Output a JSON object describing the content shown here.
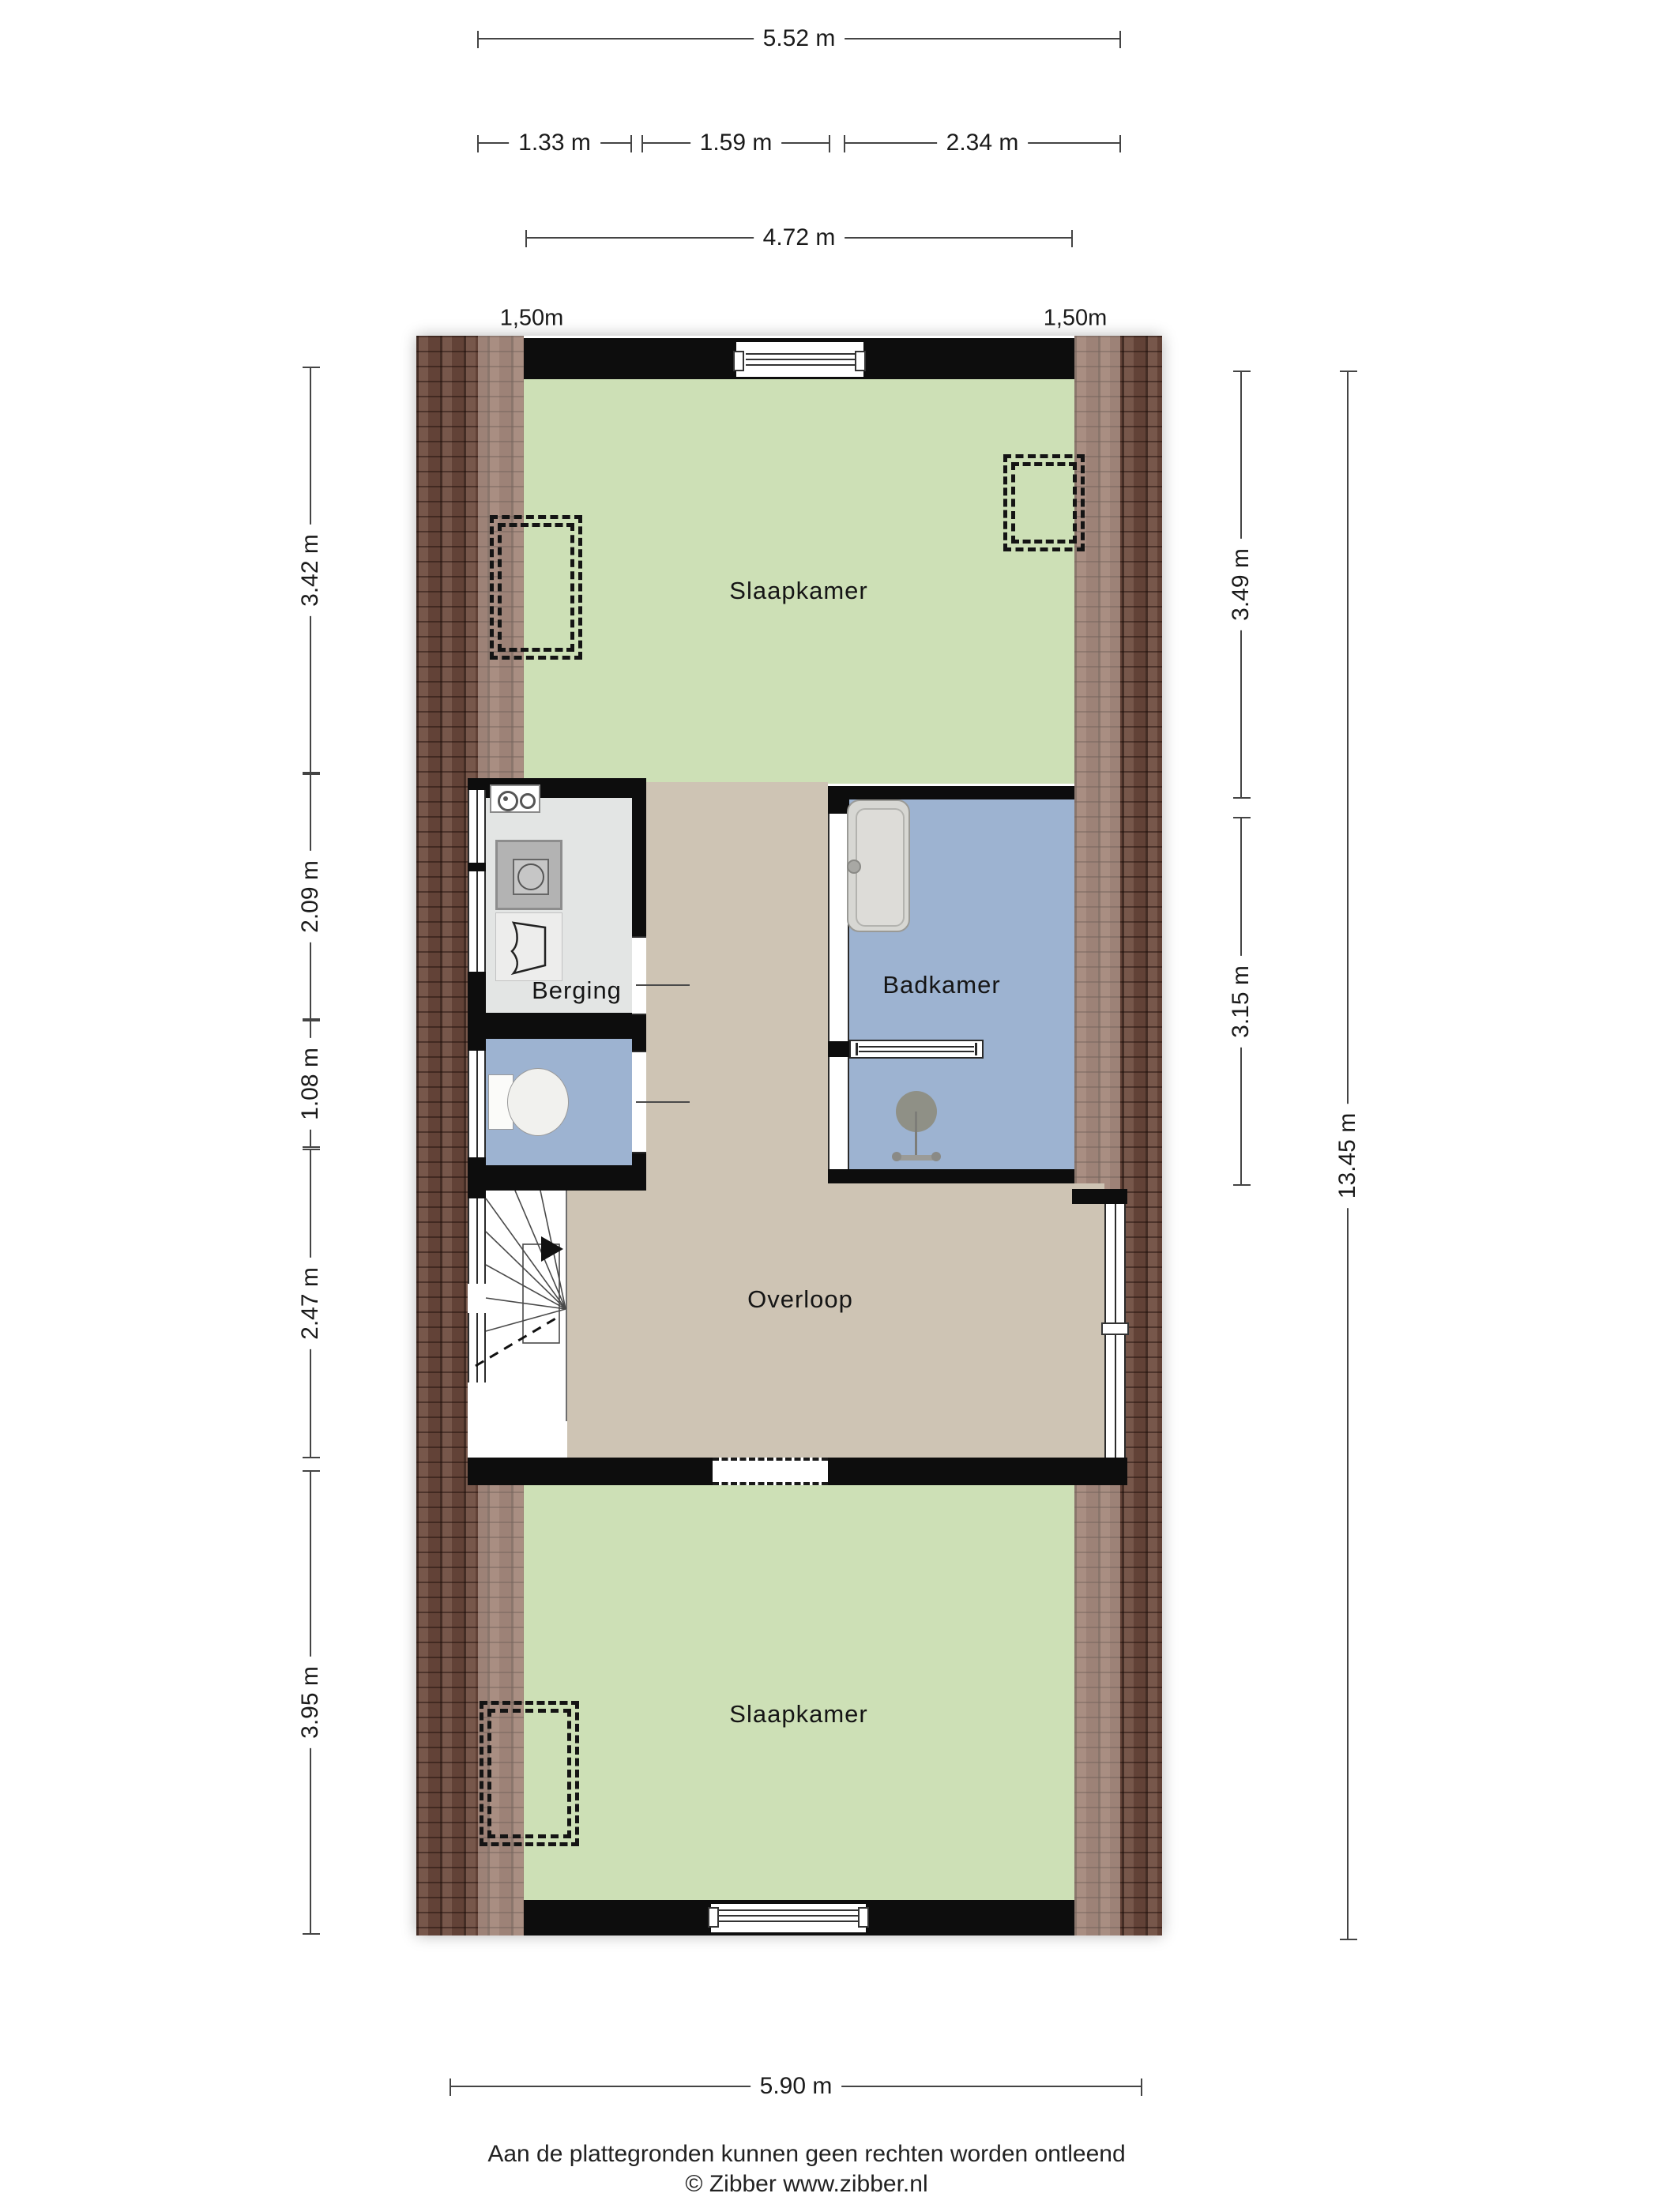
{
  "rooms": {
    "bedroom_top": {
      "label": "Slaapkamer"
    },
    "storage": {
      "label": "Berging"
    },
    "bathroom": {
      "label": "Badkamer"
    },
    "landing": {
      "label": "Overloop"
    },
    "bedroom_bottom": {
      "label": "Slaapkamer"
    }
  },
  "dimensions": {
    "top_total": "5.52 m",
    "top_seg1": "1.33 m",
    "top_seg2": "1.59 m",
    "top_seg3": "2.34 m",
    "top_inner": "4.72 m",
    "headroom_left": "1,50m",
    "headroom_right": "1,50m",
    "left_1": "3.42 m",
    "left_2": "2.09 m",
    "left_3": "1.08 m",
    "left_4": "2.47 m",
    "left_5": "3.95 m",
    "right_1": "3.49 m",
    "right_2": "3.15 m",
    "right_total": "13.45 m",
    "bottom_total": "5.90 m"
  },
  "footer": {
    "disclaimer": "Aan de plattegronden kunnen geen rechten worden ontleend",
    "copyright": "© Zibber www.zibber.nl"
  },
  "colors": {
    "bedroom": "#cde0b6",
    "landing": "#cec4b4",
    "bathroom": "#9db3d1",
    "storage": "#e3e5e4",
    "wall": "#0d0d0d",
    "brick": "#6d4a3d",
    "brick_light": "rgba(238,219,208,0.42)",
    "dimension_line": "#444444",
    "text": "#1a1a1a"
  }
}
